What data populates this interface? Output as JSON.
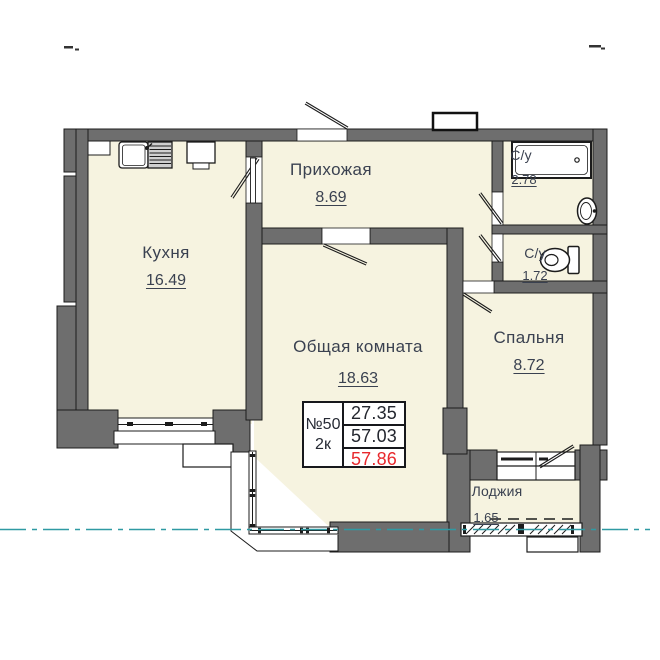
{
  "rooms": {
    "kitchen": {
      "label": "Кухня",
      "area": "16.49"
    },
    "hallway": {
      "label": "Прихожая",
      "area": "8.69"
    },
    "living": {
      "label": "Общая комната",
      "area": "18.63"
    },
    "bedroom": {
      "label": "Спальня",
      "area": "8.72"
    },
    "bathroom": {
      "label": "С/у",
      "area": "2.78"
    },
    "wc": {
      "label": "С/у",
      "area": "1.72"
    },
    "loggia": {
      "label": "Лоджия",
      "area": "1.65"
    }
  },
  "info_table": {
    "apartment_number": "№50",
    "apartment_type": "2к",
    "rows": [
      {
        "value": "27.35",
        "emphasis": "normal"
      },
      {
        "value": "57.03",
        "emphasis": "normal"
      },
      {
        "value": "57.86",
        "emphasis": "red"
      }
    ]
  },
  "fixtures": [
    "bathtub",
    "wash-basin",
    "toilet",
    "kitchen-sink",
    "kitchen-stove",
    "vent-shaft"
  ],
  "colors": {
    "wall": "#6e6e6e",
    "floor": "#f6f3e0",
    "outline": "#1c1c1c",
    "section_line": "#2f9aa3",
    "accent_red": "#e8282c",
    "label_text": "#3a4150"
  }
}
